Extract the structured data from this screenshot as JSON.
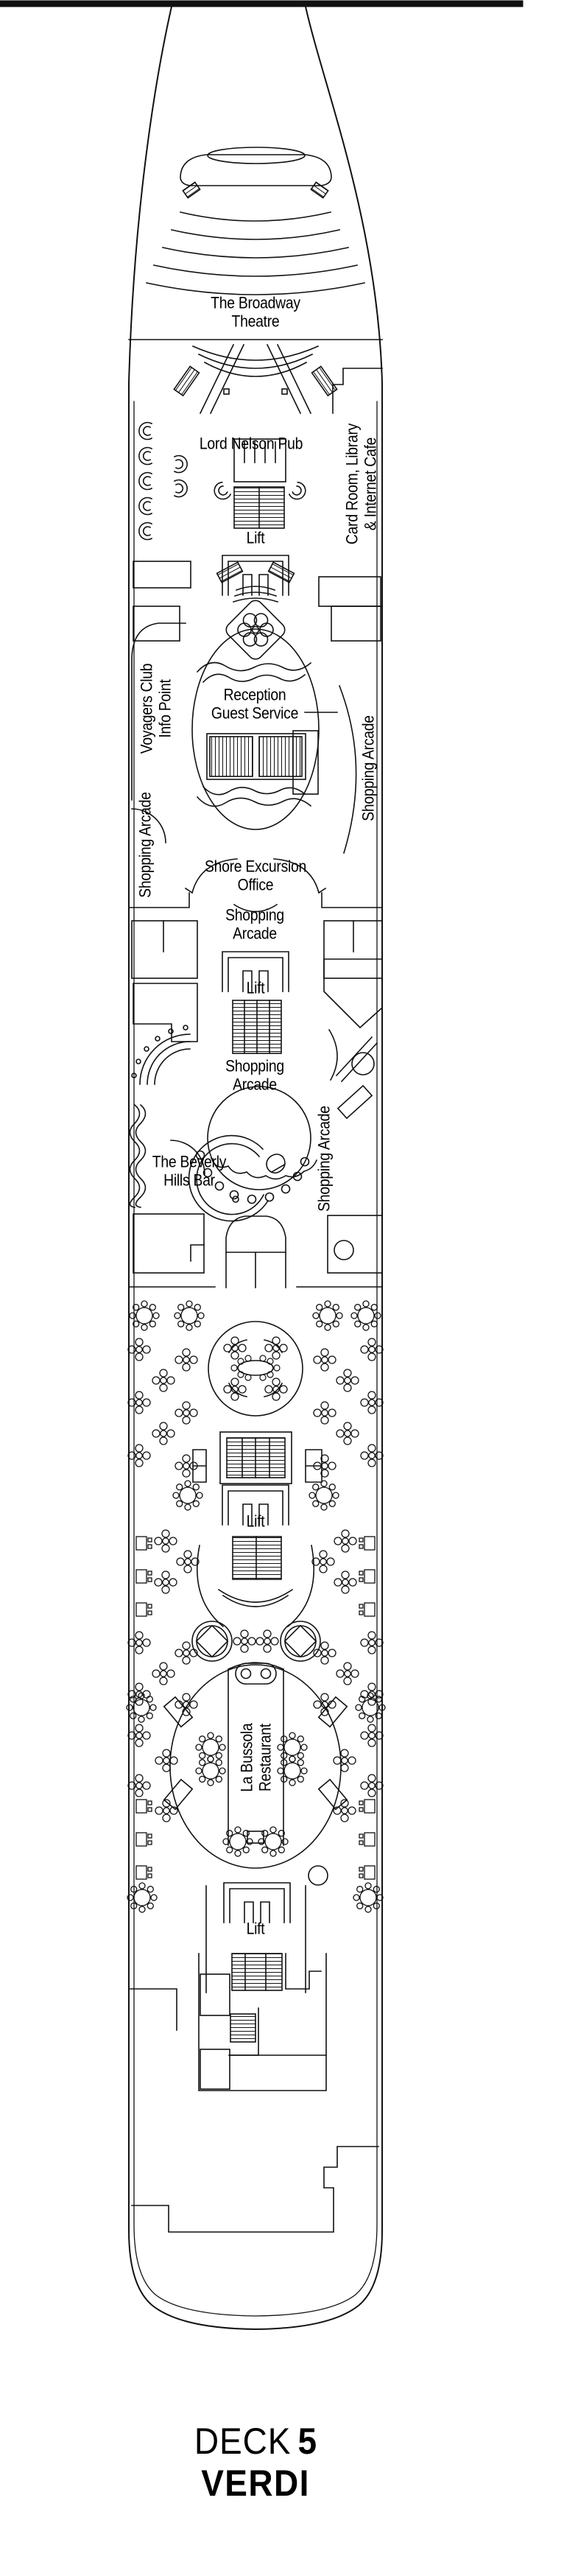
{
  "colors": {
    "ink": "#111111",
    "background": "#ffffff"
  },
  "labels": {
    "theatre": "The Broadway\nTheatre",
    "pub": "Lord Nelson Pub",
    "lift": "Lift",
    "card_room": "Card Room, Library\n& Internet Cafe",
    "voyagers": "Voyagers Club\nInfo Point",
    "reception": "Reception\nGuest Service",
    "shopping_arcade": "Shopping Arcade",
    "shopping_arcade_2l": "Shopping\nArcade",
    "shore_excursion": "Shore Excursion\nOffice",
    "beverly": "The Beverly\nHills Bar",
    "bussola": "La Bussola\nRestaurant"
  },
  "caption": {
    "deck_word": "DECK",
    "deck_number": "5",
    "deck_name": "VERDI"
  }
}
